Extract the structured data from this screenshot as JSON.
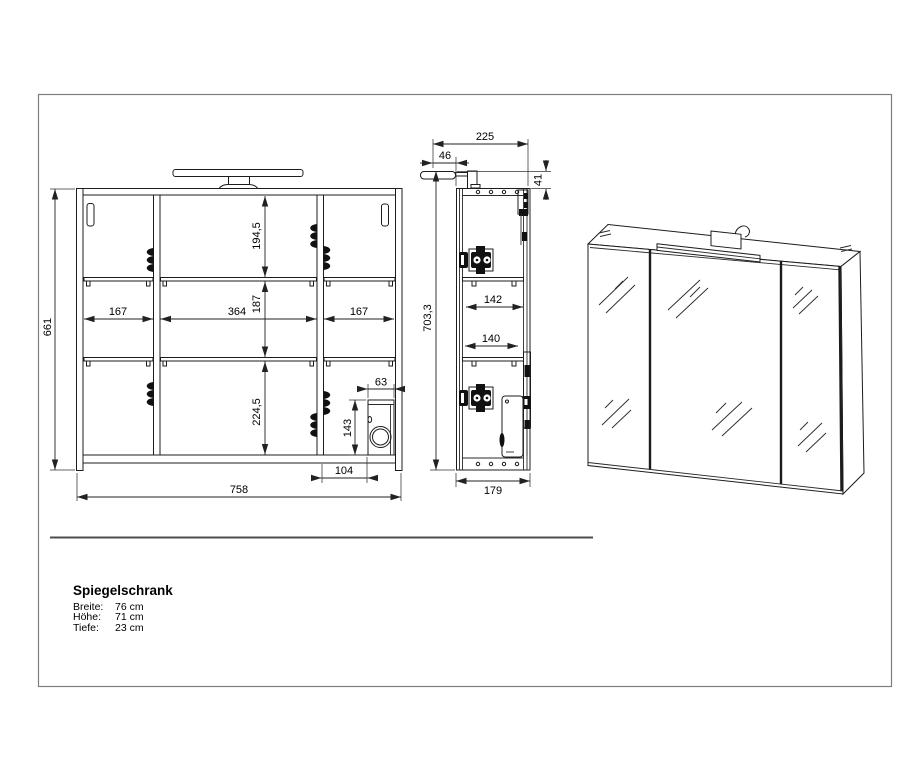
{
  "drawing": {
    "title": "Spiegelschrank",
    "specs": [
      {
        "label": "Breite:",
        "value": "76 cm"
      },
      {
        "label": "Höhe:",
        "value": "71 cm"
      },
      {
        "label": "Tiefe:",
        "value": "23 cm"
      }
    ],
    "front_view": {
      "dims": {
        "overall_height": "661",
        "overall_width": "758",
        "col_left": "167",
        "col_center": "364",
        "col_right": "167",
        "row_top": "194,5",
        "row_middle": "187",
        "row_bottom": "224,5",
        "cutout_width": "63",
        "cutout_height": "143",
        "cutout_offset": "104"
      }
    },
    "side_view": {
      "dims": {
        "overall_depth": "225",
        "lamp_overhang": "46",
        "lamp_height": "41",
        "overall_height": "703,3",
        "shelf_depth_upper": "142",
        "shelf_depth_lower": "140",
        "body_depth": "179"
      }
    },
    "colors": {
      "line": "#1c1c1c",
      "dim_line": "#222222",
      "page_border": "#7d7d7d",
      "separator": "#4d4d4d",
      "background": "#ffffff"
    }
  }
}
